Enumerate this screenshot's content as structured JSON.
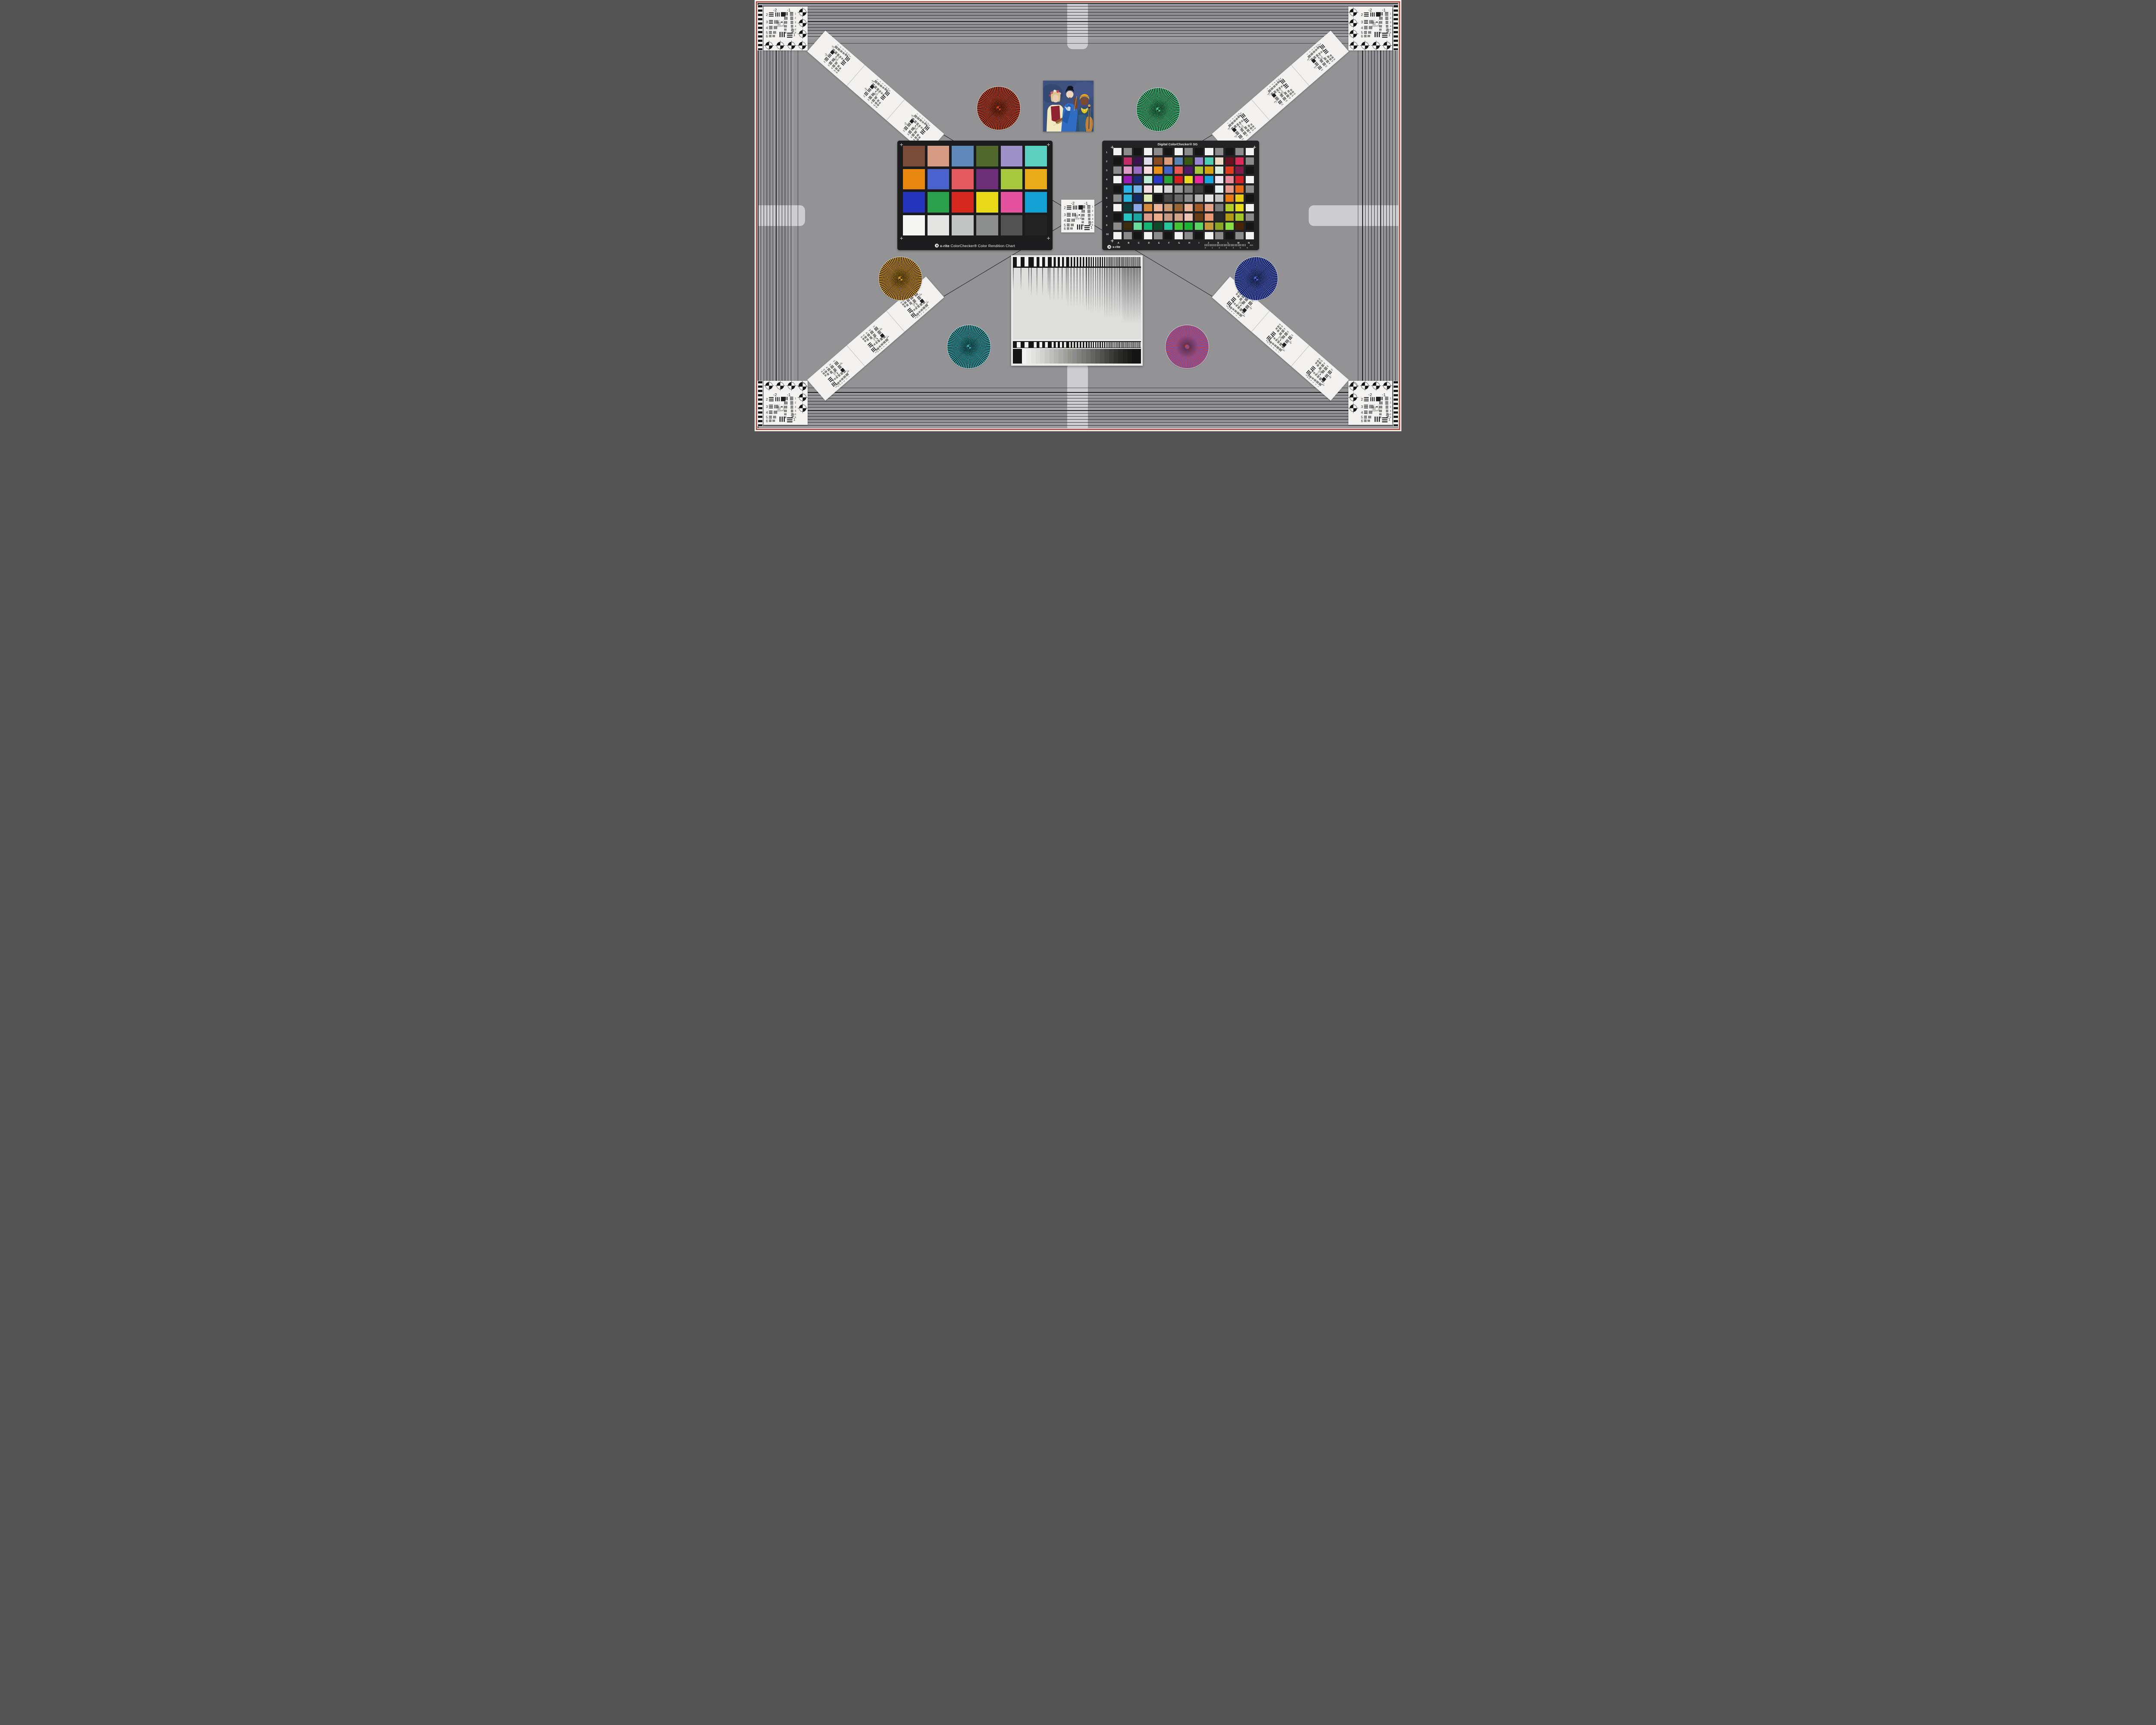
{
  "scene": {
    "description_fields": "camera test chart",
    "background": "#939395",
    "frame_color": "#c13b2b"
  },
  "colorchecker": {
    "brand": "x-rite",
    "title": "ColorChecker® Color Rendition Chart",
    "rows": [
      [
        "#7a4b39",
        "#d79b84",
        "#5d88b8",
        "#50682c",
        "#9e90c8",
        "#5bd0c0"
      ],
      [
        "#e8870e",
        "#4a62ce",
        "#e45a60",
        "#6d2f78",
        "#a8c83e",
        "#eaab18"
      ],
      [
        "#2434bc",
        "#2ba04b",
        "#d6281e",
        "#e8d816",
        "#e4529e",
        "#13a0d2"
      ],
      [
        "#f5f5f3",
        "#e3e3e1",
        "#c2c3c3",
        "#8d8e8e",
        "#535353",
        "#232323"
      ]
    ]
  },
  "sg": {
    "title": "Digital ColorChecker® SG",
    "brand": "x-rite",
    "row_labels": [
      "1",
      "2",
      "3",
      "4",
      "5",
      "6",
      "7",
      "8",
      "9",
      "10"
    ],
    "col_labels": [
      "A",
      "B",
      "C",
      "D",
      "E",
      "F",
      "G",
      "H",
      "I",
      "J",
      "K",
      "L",
      "M",
      "N"
    ],
    "ruler_numbers": [
      "0",
      "1",
      "2",
      "3",
      "4",
      "5",
      "6"
    ],
    "ruler_unit": "mm",
    "patches": [
      [
        "#f2f2f0",
        "#8b8b8b",
        "#161616",
        "#f2f2f0",
        "#8b8b8b",
        "#161616",
        "#f2f2f0",
        "#8b8b8b",
        "#161616",
        "#f2f2f0",
        "#8b8b8b",
        "#161616",
        "#8b8b8b",
        "#f2f2f0"
      ],
      [
        "#161616",
        "#c22a68",
        "#3a1450",
        "#dcdcec",
        "#8a4a22",
        "#dc9a78",
        "#5882b4",
        "#3a5a14",
        "#9a86d0",
        "#4eccb4",
        "#ecdcc4",
        "#6a1020",
        "#dc2a58",
        "#8b8b8b"
      ],
      [
        "#8b8b8b",
        "#e09ac8",
        "#9a6ac4",
        "#f4dce0",
        "#e89018",
        "#4464c8",
        "#e85a50",
        "#501a6a",
        "#a4c83a",
        "#d4a414",
        "#d8ecdc",
        "#e03c20",
        "#801a4a",
        "#161616"
      ],
      [
        "#f2f2f0",
        "#9a1ab4",
        "#1c2a78",
        "#bcecd8",
        "#2a3ac8",
        "#2aa43c",
        "#d42020",
        "#e8d820",
        "#e8289a",
        "#18a4dc",
        "#ece4f0",
        "#e88a9a",
        "#d42028",
        "#f2f2f0"
      ],
      [
        "#161616",
        "#28b4e8",
        "#74b4e8",
        "#f4dce4",
        "#f2f0ec",
        "#d4d4d4",
        "#9a9a9a",
        "#7a7a7a",
        "#3c3c3c",
        "#141414",
        "#e4f0f4",
        "#e89a8a",
        "#e86a18",
        "#8b8b8b"
      ],
      [
        "#8b8b8b",
        "#28b4dc",
        "#142a64",
        "#dcecb4",
        "#141414",
        "#4a4a4a",
        "#6a6a6a",
        "#8b8b8b",
        "#b4b4b4",
        "#e4e4e2",
        "#c4c4c4",
        "#e87a14",
        "#e8cc14",
        "#141414"
      ],
      [
        "#f2f2f0",
        "#0c3c3c",
        "#8aa8e8",
        "#d88a3c",
        "#ecb49a",
        "#c89a74",
        "#9a6434",
        "#ecb49a",
        "#a45a24",
        "#e8a48a",
        "#7a7a7a",
        "#b4cc28",
        "#e8dc18",
        "#f2f2f0"
      ],
      [
        "#161616",
        "#28c4c4",
        "#1ca4a4",
        "#dc9a8a",
        "#ecac8a",
        "#c49a84",
        "#d4a48a",
        "#ecc4b4",
        "#6a3c14",
        "#e89a74",
        "#2a2a2a",
        "#b49a14",
        "#a4c428",
        "#8b8b8b"
      ],
      [
        "#8b8b8b",
        "#3c2c0c",
        "#6adc9a",
        "#14b474",
        "#0c4a2a",
        "#2ac49a",
        "#44c434",
        "#1cb434",
        "#5ad464",
        "#c49a3c",
        "#8aa424",
        "#8adc44",
        "#4a2408",
        "#161616"
      ],
      [
        "#f2f2f0",
        "#8b8b8b",
        "#161616",
        "#f2f2f0",
        "#8b8b8b",
        "#161616",
        "#f2f2f0",
        "#8b8b8b",
        "#161616",
        "#f2f2f0",
        "#8b8b8b",
        "#161616",
        "#8b8b8b",
        "#f2f2f0"
      ]
    ]
  },
  "usaf": {
    "top_left": "-2",
    "top_right": "-1",
    "left": [
      "2",
      "3",
      "4",
      "5",
      "6"
    ],
    "right": [
      "1",
      "2",
      "3",
      "4",
      "5",
      "6"
    ],
    "corner": "-2",
    "corner_num": "1",
    "inner_top_left": "0",
    "inner_top_right": "1",
    "inner_left": [
      "2",
      "3",
      "4",
      "5",
      "6"
    ],
    "inner_bottom_left": "0",
    "inner_bottom_right": "1"
  },
  "stars": [
    {
      "name": "red",
      "spoke": "#d8421a",
      "gap": "#20130e"
    },
    {
      "name": "green",
      "spoke": "#3ecb85",
      "gap": "#0e2a1a"
    },
    {
      "name": "amber",
      "spoke": "#d89c1e",
      "gap": "#2a1d06"
    },
    {
      "name": "navy",
      "spoke": "#4d68d8",
      "gap": "#0e1028"
    },
    {
      "name": "teal",
      "spoke": "#2eb2b8",
      "gap": "#0a2224"
    },
    {
      "name": "red-blue",
      "spoke": "#e03e28",
      "gap": "#4858d8"
    }
  ],
  "grayscale": {
    "steps": [
      "#f2f2f0",
      "#eaeae8",
      "#e2e2e0",
      "#dadad8",
      "#d2d2d0",
      "#c8c8c6",
      "#bebebc",
      "#b4b4b2",
      "#aaaaa8",
      "#a0a09e",
      "#96968f",
      "#8c8c8a",
      "#828280",
      "#787876",
      "#6e6e6c",
      "#646462",
      "#5a5a58",
      "#50504e",
      "#464644",
      "#3c3c3a",
      "#323230",
      "#2a2a28",
      "#222220",
      "#1a1a18"
    ]
  }
}
